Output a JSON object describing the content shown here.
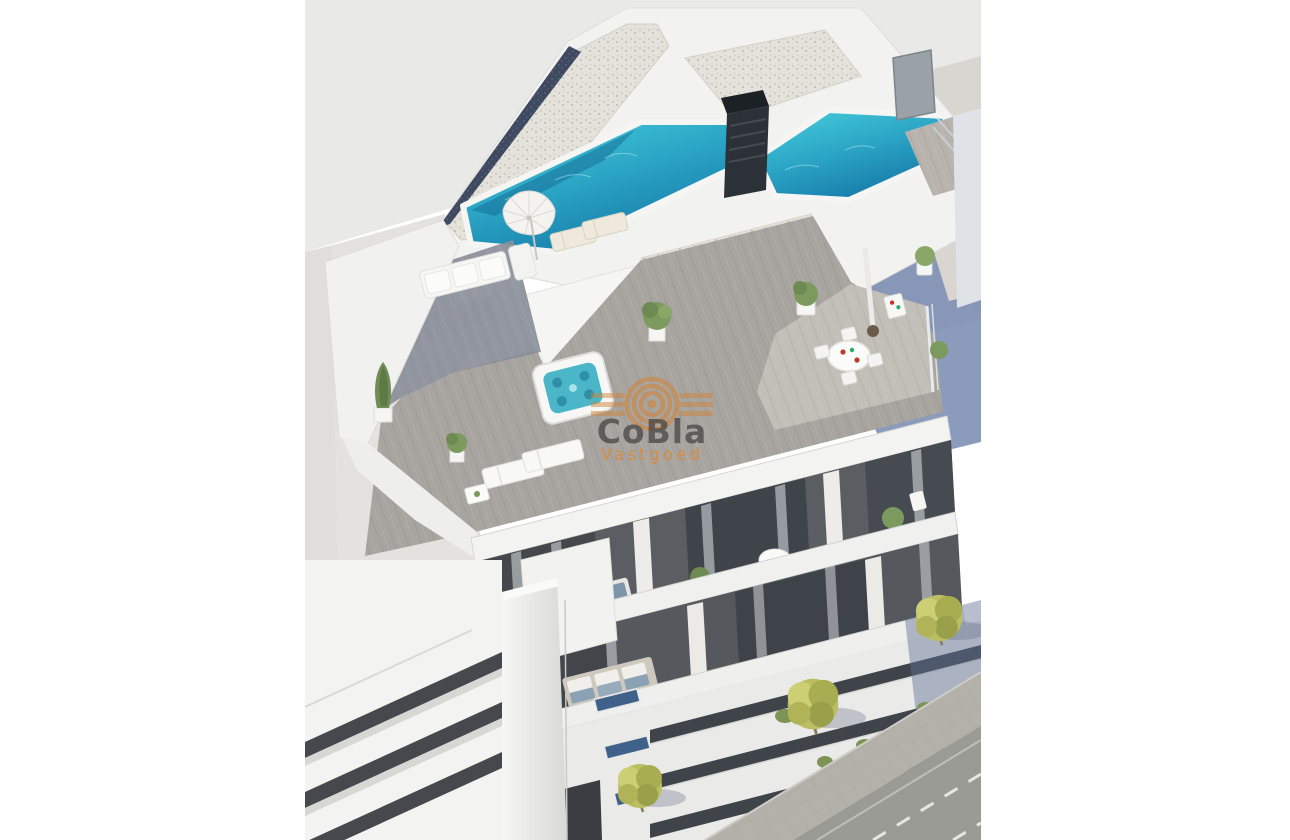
{
  "watermark": {
    "brand": "CoBla",
    "tagline": "Vastgoed",
    "brand_color": "#464646",
    "tagline_color": "#d98a3a",
    "logo_color": "#d0853c",
    "logo_shape": "concentric-rings-with-side-slats"
  },
  "palette": {
    "page_background": "#ffffff",
    "ground_light": "#e9e9e7",
    "ground_warm": "#d9d5d0",
    "building_white": "#f2f2f0",
    "facade_dark": "#55595e",
    "pool_water_light": "#3ec8d8",
    "pool_water_deep": "#1579a8",
    "chimney_dark": "#2b3137",
    "deck_wood": "#a8a49f",
    "shadow_blue": "#7e90b5",
    "street_asphalt": "#9b9b95",
    "sidewalk": "#b4b1ab",
    "tree_foliage": "#bcbe62",
    "window_glass_blue": "#3f618a"
  },
  "scene": {
    "type": "aerial-3d-architectural-render",
    "elements": [
      "rooftop-pool",
      "gravel-roof",
      "chimney-vent",
      "roof-terrace-deck",
      "jacuzzi",
      "sun-loungers",
      "parasol",
      "outdoor-sofa",
      "dining-table",
      "penthouse-volumes",
      "balcony-floors",
      "curtained-glass-doors",
      "potted-plants",
      "lower-floor-bands",
      "window-slits",
      "neighbor-building",
      "sidewalk",
      "street-with-lane-markings",
      "street-trees",
      "cast-shadow-on-ground"
    ]
  }
}
